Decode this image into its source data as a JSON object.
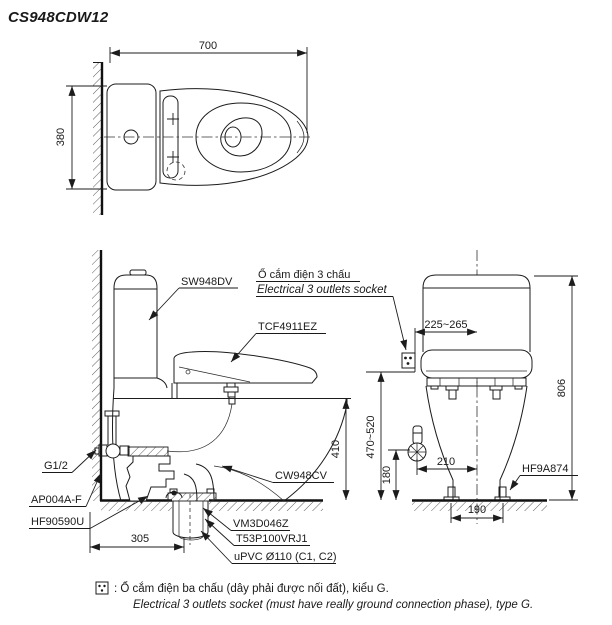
{
  "title": "CS948CDW12",
  "colors": {
    "ink": "#1a1a1a",
    "paper": "#ffffff"
  },
  "top_view": {
    "dim_width": "700",
    "dim_depth": "380"
  },
  "side_view": {
    "label_tank": "SW948DV",
    "label_socket_vi": "Ổ cắm điện 3 chấu",
    "label_socket_en": "Electrical 3 outlets socket",
    "label_seat_unit": "TCF4911EZ",
    "label_bowl": "CW948CV",
    "label_supply_thread": "G1/2",
    "label_stop_valve": "AP004A-F",
    "label_fixing_bolt": "HF90590U",
    "label_flange": "VM3D046Z",
    "label_joint": "T53P100VRJ1",
    "label_drain_pipe": "uPVC Ø110 (C1, C2)",
    "dim_rim_height": "410",
    "dim_drain_offset": "305"
  },
  "front_view": {
    "label_foot_cap": "HF9A874",
    "dim_socket_offset": "225~265",
    "dim_socket_height": "470~520",
    "dim_valve_height": "180",
    "dim_valve_offset": "210",
    "dim_bolt_spacing": "190",
    "dim_total_height": "806"
  },
  "footnote": {
    "vi": ": Ổ cắm điện ba chấu (dây phải được nối đất), kiểu G.",
    "en": "Electrical 3 outlets socket (must have really ground connection phase), type G."
  }
}
